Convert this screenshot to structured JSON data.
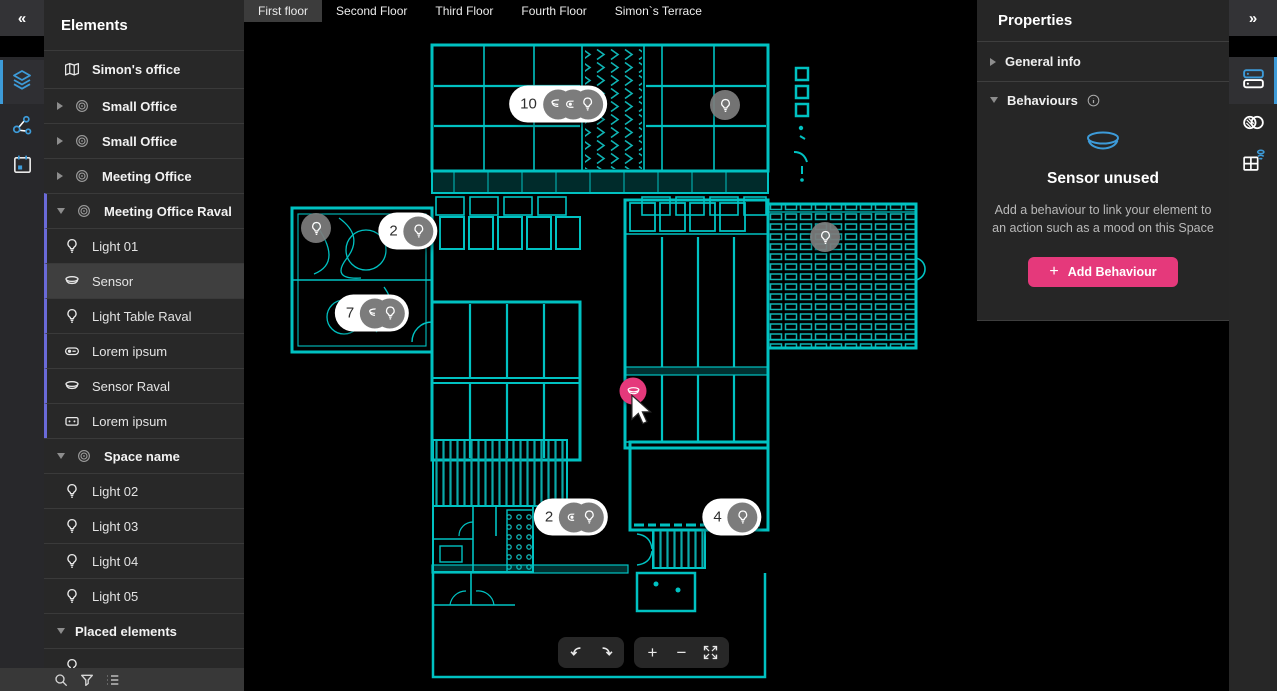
{
  "left_rail": {
    "collapse_glyph": "«",
    "tools": [
      {
        "name": "layers",
        "active": true
      },
      {
        "name": "connections",
        "active": false
      },
      {
        "name": "schedule",
        "active": false
      }
    ]
  },
  "sidebar": {
    "title": "Elements",
    "items": [
      {
        "label": "Simon's office",
        "icon": "map",
        "kind": "root"
      },
      {
        "label": "Small Office",
        "icon": "space",
        "kind": "group",
        "chevron": "right"
      },
      {
        "label": "Small Office",
        "icon": "space",
        "kind": "group",
        "chevron": "right"
      },
      {
        "label": "Meeting Office",
        "icon": "space",
        "kind": "group",
        "chevron": "right"
      },
      {
        "label": "Meeting Office Raval",
        "icon": "space",
        "kind": "group",
        "chevron": "down",
        "grouped": true
      },
      {
        "label": "Light 01",
        "icon": "bulb",
        "kind": "leaf",
        "grouped": true
      },
      {
        "label": "Sensor",
        "icon": "sensor",
        "kind": "leaf",
        "grouped": true,
        "selected": true
      },
      {
        "label": "Light Table Raval",
        "icon": "bulb",
        "kind": "leaf",
        "grouped": true
      },
      {
        "label": "Lorem ipsum",
        "icon": "switch",
        "kind": "leaf",
        "grouped": true
      },
      {
        "label": "Sensor Raval",
        "icon": "sensor",
        "kind": "leaf",
        "grouped": true
      },
      {
        "label": "Lorem ipsum",
        "icon": "controller",
        "kind": "leaf",
        "grouped": true
      },
      {
        "label": "Space name",
        "icon": "space",
        "kind": "group",
        "chevron": "down"
      },
      {
        "label": "Light 02",
        "icon": "bulb",
        "kind": "leaf"
      },
      {
        "label": "Light 03",
        "icon": "bulb",
        "kind": "leaf"
      },
      {
        "label": "Light 04",
        "icon": "bulb",
        "kind": "leaf"
      },
      {
        "label": "Light 05",
        "icon": "bulb",
        "kind": "leaf"
      },
      {
        "label": "Placed elements",
        "kind": "section",
        "chevron": "down"
      },
      {
        "label": "",
        "icon": "bulb",
        "kind": "leaf",
        "partial": true
      }
    ],
    "footer_tools": [
      "search",
      "filter",
      "list"
    ]
  },
  "tabs": {
    "add_glyph": "+",
    "items": [
      {
        "label": "First floor",
        "active": true
      },
      {
        "label": "Second Floor",
        "active": false
      },
      {
        "label": "Third Floor",
        "active": false
      },
      {
        "label": "Fourth Floor",
        "active": false
      },
      {
        "label": "Simon`s Terrace",
        "active": false
      }
    ]
  },
  "canvas": {
    "markers": [
      {
        "kind": "cluster",
        "count": "10",
        "icons": [
          "sensor",
          "switch",
          "bulb"
        ],
        "x": 314,
        "y": 82
      },
      {
        "kind": "single",
        "icons": [
          "bulb"
        ],
        "x": 481,
        "y": 83
      },
      {
        "kind": "single",
        "icons": [
          "bulb"
        ],
        "x": 72,
        "y": 206
      },
      {
        "kind": "cluster",
        "count": "2",
        "icons": [
          "bulb"
        ],
        "x": 164,
        "y": 209
      },
      {
        "kind": "single",
        "icons": [
          "bulb"
        ],
        "x": 581,
        "y": 215
      },
      {
        "kind": "cluster",
        "count": "7",
        "icons": [
          "sensor",
          "bulb"
        ],
        "x": 128,
        "y": 291
      },
      {
        "kind": "selected",
        "icons": [
          "sensor"
        ],
        "x": 389,
        "y": 369
      },
      {
        "kind": "cluster",
        "count": "2",
        "icons": [
          "switch",
          "bulb"
        ],
        "x": 327,
        "y": 495
      },
      {
        "kind": "cluster",
        "count": "4",
        "icons": [
          "bulb"
        ],
        "x": 488,
        "y": 495
      }
    ],
    "toolbar": {
      "zoom_in_glyph": "+",
      "zoom_out_glyph": "−"
    }
  },
  "properties": {
    "title": "Properties",
    "general_info_label": "General info",
    "behaviours_label": "Behaviours",
    "empty_state": {
      "title": "Sensor unused",
      "description": "Add a behaviour to link your element to an action such as a mood on this Space",
      "button_plus": "+",
      "button_label": "Add Behaviour"
    }
  },
  "right_rail": {
    "expand_glyph": "»",
    "tools": [
      {
        "name": "properties-panel",
        "active": true
      },
      {
        "name": "links",
        "active": false
      },
      {
        "name": "room-sensor",
        "active": false
      }
    ]
  },
  "colors": {
    "teal": "#00c2c2",
    "accent_blue": "#3d9bd9",
    "tab_add_blue": "#4da6e0",
    "pink": "#e5397b",
    "marker_gray": "#7c7c7c",
    "selected_row": "#3f3f3f",
    "purple_group_bar": "#6a6ad8"
  }
}
